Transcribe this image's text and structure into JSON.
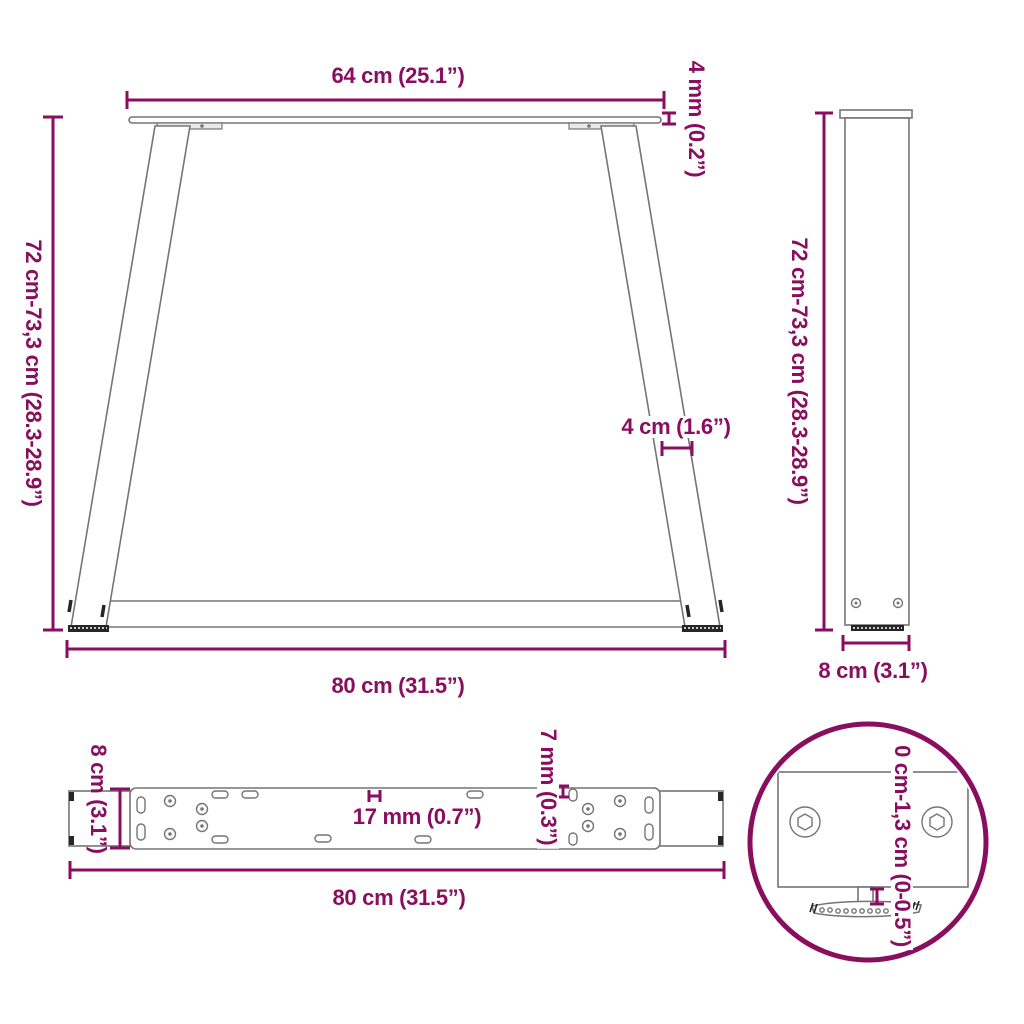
{
  "colors": {
    "dimension": "#8A0E5F",
    "object_outline": "#757575",
    "object_dark": "#262626",
    "background": "#ffffff"
  },
  "views": {
    "front": {
      "top_width": "64 cm (25.1”)",
      "plate_thickness": "4 mm (0.2”)",
      "height": "72 cm-73,3 cm (28.3-28.9”)",
      "leg_width": "4 cm (1.6”)",
      "bottom_width": "80 cm (31.5”)"
    },
    "side": {
      "height": "72 cm-73,3 cm (28.3-28.9”)",
      "depth": "8 cm (3.1”)"
    },
    "top": {
      "depth": "8 cm (3.1”)",
      "slot_width": "17 mm (0.7”)",
      "slot_height": "7 mm (0.3”)",
      "length": "80 cm (31.5”)"
    },
    "detail": {
      "adjust_range": "0 cm-1,3 cm (0-0.5”)"
    }
  }
}
